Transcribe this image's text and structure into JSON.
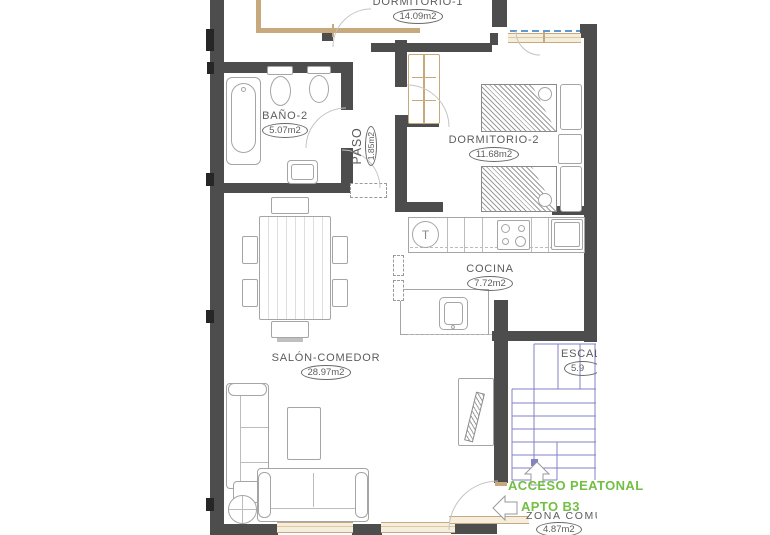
{
  "plan": {
    "rooms": {
      "dormitorio1": {
        "name": "DORMITORIO-1",
        "area": "14.09m2"
      },
      "bano2": {
        "name": "BAÑO-2",
        "area": "5.07m2"
      },
      "paso": {
        "name": "PASO",
        "area": "1.85m2"
      },
      "dormitorio2": {
        "name": "DORMITORIO-2",
        "area": "11.68m2"
      },
      "cocina": {
        "name": "COCINA",
        "area": "7.72m2"
      },
      "salon": {
        "name": "SALÓN-COMEDOR",
        "area": "28.97m2"
      },
      "escalera": {
        "name": "ESCAL",
        "area": "5.9"
      },
      "zona_comun": {
        "name": "ZONA COMÚ",
        "area": "4.87m2"
      }
    },
    "annotations": {
      "acceso_peatonal": "ACCESO PEATONAL",
      "apto": "APTO B3"
    },
    "kitchen": {
      "faucet_mark": "T"
    },
    "colors": {
      "wall": "#4d4d4d",
      "carpentry_tan": "#c8a97e",
      "stairs_blue": "#8282c4",
      "glass_blue": "#5b9bd5",
      "annotation_green": "#72bf44",
      "furniture_line": "#a5a5a5"
    }
  }
}
